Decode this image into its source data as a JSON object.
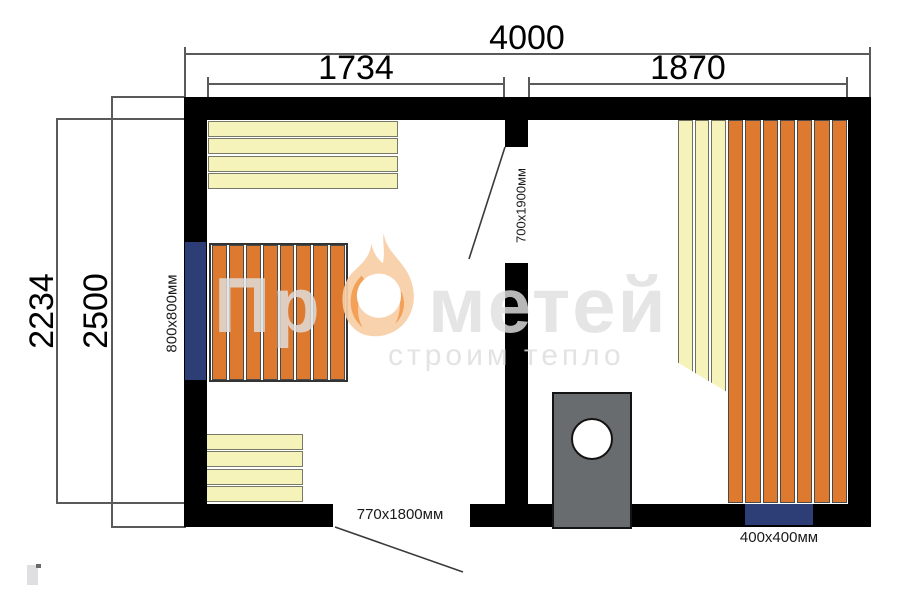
{
  "plan": {
    "dimensions": {
      "total_width": "4000",
      "left_room_width": "1734",
      "right_room_width": "1870",
      "inner_depth": "2234",
      "total_depth": "2500"
    },
    "fixtures": {
      "left_window_label": "800x800мм",
      "partition_door_label": "700x1900мм",
      "entry_door_label": "770x1800мм",
      "bottom_window_label": "400x400мм"
    },
    "colors": {
      "wall": "#000000",
      "bench_yellow": "#f5f3ba",
      "bench_orange": "#dd7a2f",
      "window_blue": "#2c3e75",
      "stove_gray": "#696c6e",
      "dimension_line": "#5a5a5a"
    }
  },
  "watermark": {
    "brand_prefix": "Пр",
    "brand_suffix": "метей",
    "tagline": "строим тепло",
    "flame_body_color": "#f8cfa5",
    "flame_accent_color": "#f2984a"
  }
}
